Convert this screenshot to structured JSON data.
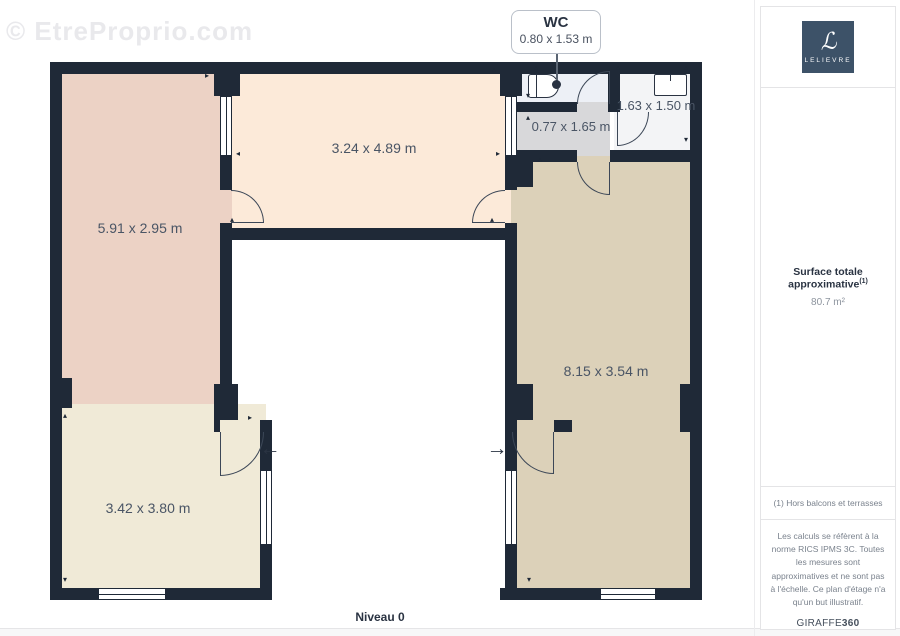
{
  "watermark": "© EtreProprio.com",
  "plan": {
    "level_label": "Niveau 0",
    "wall_color": "#1f2937",
    "door_color": "#3c4757",
    "label_color": "#4a5565",
    "callout": {
      "title": "WC",
      "dimensions": "0.80 x 1.53 m"
    },
    "entry_arrows": {
      "left": "←",
      "right": "→"
    },
    "rooms": [
      {
        "name": "room-top-left",
        "dimensions": "5.91 x 2.95 m",
        "color": "#ecd2c5"
      },
      {
        "name": "room-top-middle",
        "dimensions": "3.24 x 4.89 m",
        "color": "#fcead9"
      },
      {
        "name": "wc",
        "color": "#edf0f6"
      },
      {
        "name": "room-top-right",
        "dimensions": "1.63 x 1.50 m",
        "color": "#f3f4f6"
      },
      {
        "name": "hallway",
        "dimensions": "0.77 x 1.65 m",
        "color": "#d8d8da"
      },
      {
        "name": "room-right",
        "dimensions": "8.15 x 3.54 m",
        "color": "#dcd1b9"
      },
      {
        "name": "room-bottom-left",
        "dimensions": "3.42 x 3.80 m",
        "color": "#f0ead7"
      }
    ],
    "markers": {
      "up": "▴",
      "down": "▾",
      "left": "◂",
      "right": "▸"
    }
  },
  "sidebar": {
    "logo": {
      "monogram": "ℒ",
      "text": "LELIEVRE",
      "bg_color": "#3d5268"
    },
    "surface": {
      "label": "Surface totale approximative",
      "superscript": "(1)",
      "value": "80.7 m²"
    },
    "footnote": "(1) Hors balcons et terrasses",
    "disclaimer": "Les calculs se réfèrent à la norme RICS IPMS 3C. Toutes les mesures sont approximatives et ne sont pas à l'échelle. Ce plan d'étage n'a qu'un but illustratif.",
    "brand": {
      "name": "GIRAFFE",
      "suffix": "360"
    }
  }
}
